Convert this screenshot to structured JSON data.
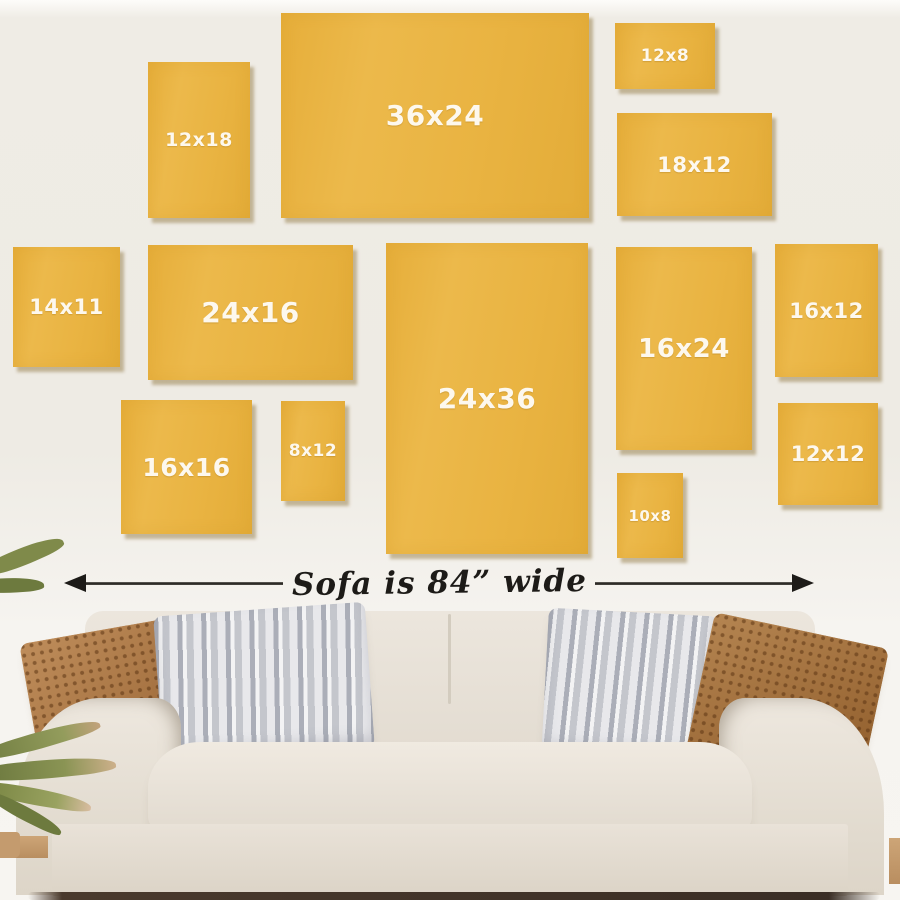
{
  "wall_art_guide": {
    "frames": [
      {
        "label": "12x18",
        "x": 148,
        "y": 62,
        "w": 102,
        "h": 156,
        "fs": 19
      },
      {
        "label": "36x24",
        "x": 281,
        "y": 13,
        "w": 308,
        "h": 205,
        "fs": 28
      },
      {
        "label": "12x8",
        "x": 615,
        "y": 23,
        "w": 100,
        "h": 66,
        "fs": 17
      },
      {
        "label": "18x12",
        "x": 617,
        "y": 113,
        "w": 155,
        "h": 103,
        "fs": 21
      },
      {
        "label": "14x11",
        "x": 13,
        "y": 247,
        "w": 107,
        "h": 120,
        "fs": 21
      },
      {
        "label": "24x16",
        "x": 148,
        "y": 245,
        "w": 205,
        "h": 135,
        "fs": 28
      },
      {
        "label": "16x16",
        "x": 121,
        "y": 400,
        "w": 131,
        "h": 134,
        "fs": 25
      },
      {
        "label": "8x12",
        "x": 281,
        "y": 401,
        "w": 64,
        "h": 100,
        "fs": 17
      },
      {
        "label": "24x36",
        "x": 386,
        "y": 243,
        "w": 202,
        "h": 311,
        "fs": 28
      },
      {
        "label": "16x24",
        "x": 616,
        "y": 247,
        "w": 136,
        "h": 203,
        "fs": 26
      },
      {
        "label": "16x12",
        "x": 775,
        "y": 244,
        "w": 103,
        "h": 133,
        "fs": 21
      },
      {
        "label": "12x12",
        "x": 778,
        "y": 403,
        "w": 100,
        "h": 102,
        "fs": 21
      },
      {
        "label": "10x8",
        "x": 617,
        "y": 473,
        "w": 66,
        "h": 85,
        "fs": 15
      }
    ],
    "arrow": {
      "label": "Sofa is 84” wide"
    },
    "colors": {
      "frame_fill": "#e9b341",
      "frame_text": "#fdf8ee",
      "frame_shadow": "#806426",
      "wall_top": "#eeebe4",
      "wall_bottom": "#f7f5f1",
      "arrow": "#1d1b18",
      "sofa_body": "#e7e1d7",
      "pillow_rust": "#a9713d",
      "pillow_gray": "#d6d7da",
      "leaf_green": "#7f8a4a",
      "floor": "#3a2e25"
    }
  }
}
